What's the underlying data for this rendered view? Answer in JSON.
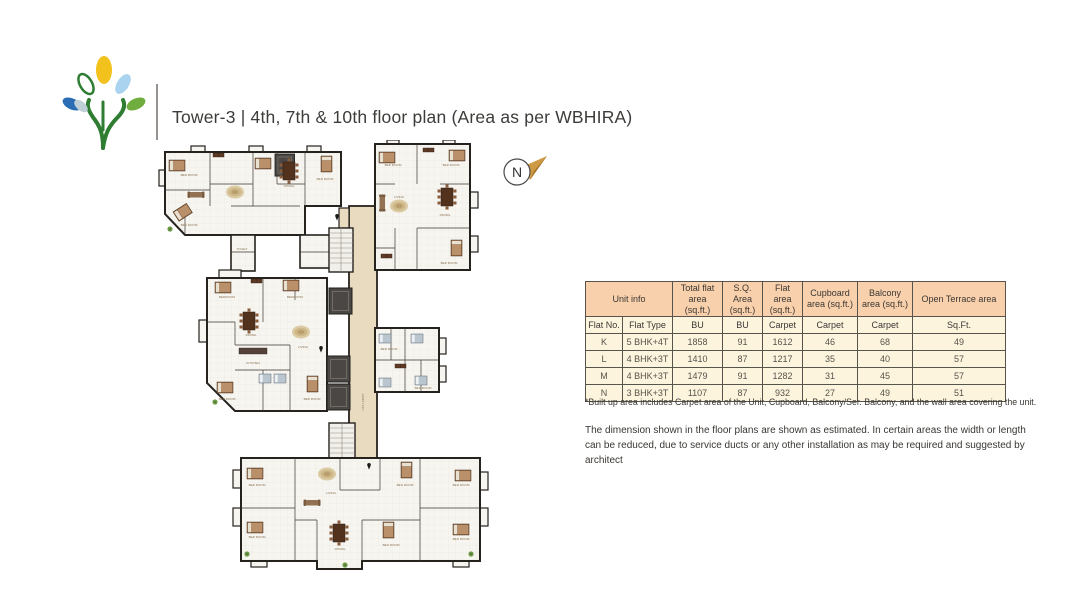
{
  "header": {
    "title": "Tower-3 | 4th, 7th & 10th floor plan (Area as per WBHIRA)"
  },
  "logo": {
    "name": "tree-logo",
    "leaf_colors": {
      "top": "#f2c11c",
      "left_outline": "#2e7d33",
      "right": "#a9d3ee",
      "far_left": "#2a6db4",
      "far_right": "#6fae3e",
      "trunk": "#2e7d33"
    }
  },
  "compass": {
    "label": "N",
    "arrow_color": "#cf9a45"
  },
  "plan": {
    "colors": {
      "wall": "#26221e",
      "floor": "#f7f5f0",
      "corridor": "#e8dbbf",
      "shaft": "#4a4744",
      "furniture": "#8a5c3b",
      "bed_blue": "#b9c6cf"
    },
    "labels": [
      "BED ROOM",
      "DINING",
      "BED ROOM",
      "BED ROOM",
      "TOILET",
      "BED ROOM",
      "BED ROOM",
      "LIVING",
      "DINING",
      "BED ROOM",
      "BEDROOM",
      "BEDROOM",
      "DINING",
      "LIVING",
      "KITCHEN",
      "BED ROOM",
      "BED ROOM",
      "BED ROOM",
      "BED ROOM",
      "LIFT LOBBY",
      "BED ROOM",
      "BED ROOM",
      "BED ROOM",
      "BED ROOM",
      "DINING",
      "BED ROOM",
      "BED ROOM",
      "LIVING"
    ]
  },
  "table": {
    "colors": {
      "header_bg": "#f8d0ab",
      "body_bg": "#fdf4de",
      "border": "#57534d"
    },
    "group_headers": [
      "Unit info",
      "Total flat area (sq.ft.)",
      "S.Q. Area (sq.ft.)",
      "Flat area (sq.ft.)",
      "Cupboard area (sq.ft.)",
      "Balcony area (sq.ft.)",
      "Open Terrace area"
    ],
    "sub_headers": [
      "Flat No.",
      "Flat Type",
      "BU",
      "BU",
      "Carpet",
      "Carpet",
      "Carpet",
      "Sq.Ft."
    ],
    "rows": [
      [
        "K",
        "5 BHK+4T",
        "1858",
        "91",
        "1612",
        "46",
        "68",
        "49"
      ],
      [
        "L",
        "4 BHK+3T",
        "1410",
        "87",
        "1217",
        "35",
        "40",
        "57"
      ],
      [
        "M",
        "4 BHK+3T",
        "1479",
        "91",
        "1282",
        "31",
        "45",
        "57"
      ],
      [
        "N",
        "3 BHK+3T",
        "1107",
        "87",
        "932",
        "27",
        "49",
        "51"
      ]
    ],
    "footnote": "*Built up area includes Carpet area of the Unit, Cupboard, Balcony/Ser. Balcony, and the wall area covering the unit."
  },
  "disclaimer": "The dimension shown in the floor plans are shown as estimated. In certain areas the width or length can be reduced, due to service ducts or any other installation as may be required and suggested by architect"
}
